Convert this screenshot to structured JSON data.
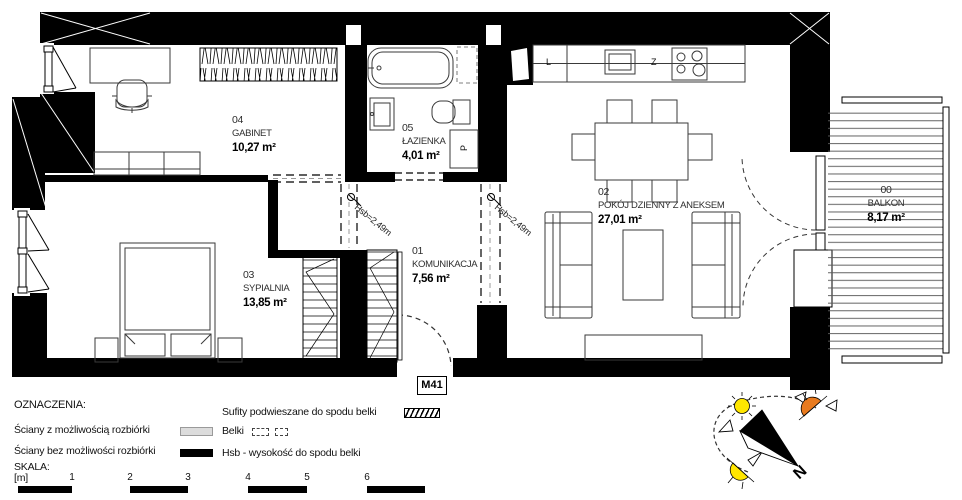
{
  "plan": {
    "unit_label": "M41",
    "hsb_label": "Hsb=2,49m",
    "rooms": [
      {
        "id": "04",
        "name": "GABINET",
        "area": "10,27 m²"
      },
      {
        "id": "05",
        "name": "ŁAZIENKA",
        "area": "4,01 m²"
      },
      {
        "id": "03",
        "name": "SYPIALNIA",
        "area": "13,85 m²"
      },
      {
        "id": "01",
        "name": "KOMUNIKACJA",
        "area": "7,56 m²"
      },
      {
        "id": "02",
        "name": "POKÓJ DZIENNY Z ANEKSEM",
        "area": "27,01 m²"
      },
      {
        "id": "00",
        "name": "BALKON",
        "area": "8,17 m²"
      }
    ],
    "appliance_letters": {
      "fridge": "L",
      "sink": "Z",
      "washer": "P"
    }
  },
  "legend": {
    "title": "OZNACZENIA:",
    "wall_demolish": "Ściany z możliwością rozbiórki",
    "wall_no_demolish": "Ściany bez możliwości rozbiórki",
    "ceilings": "Sufity podwieszane do spodu belki",
    "beams": "Belki",
    "hsb": "Hsb - wysokość do spodu belki",
    "scale_title": "SKALA:",
    "scale_unit": "[m]",
    "scale_ticks": [
      "1",
      "2",
      "3",
      "4",
      "5",
      "6"
    ]
  },
  "compass": {
    "north_label": "N"
  },
  "colors": {
    "wall": "#000000",
    "demolish_wall": "#dcdcdc",
    "sun_yellow": "#ffe600",
    "sun_orange": "#e87a1e"
  }
}
